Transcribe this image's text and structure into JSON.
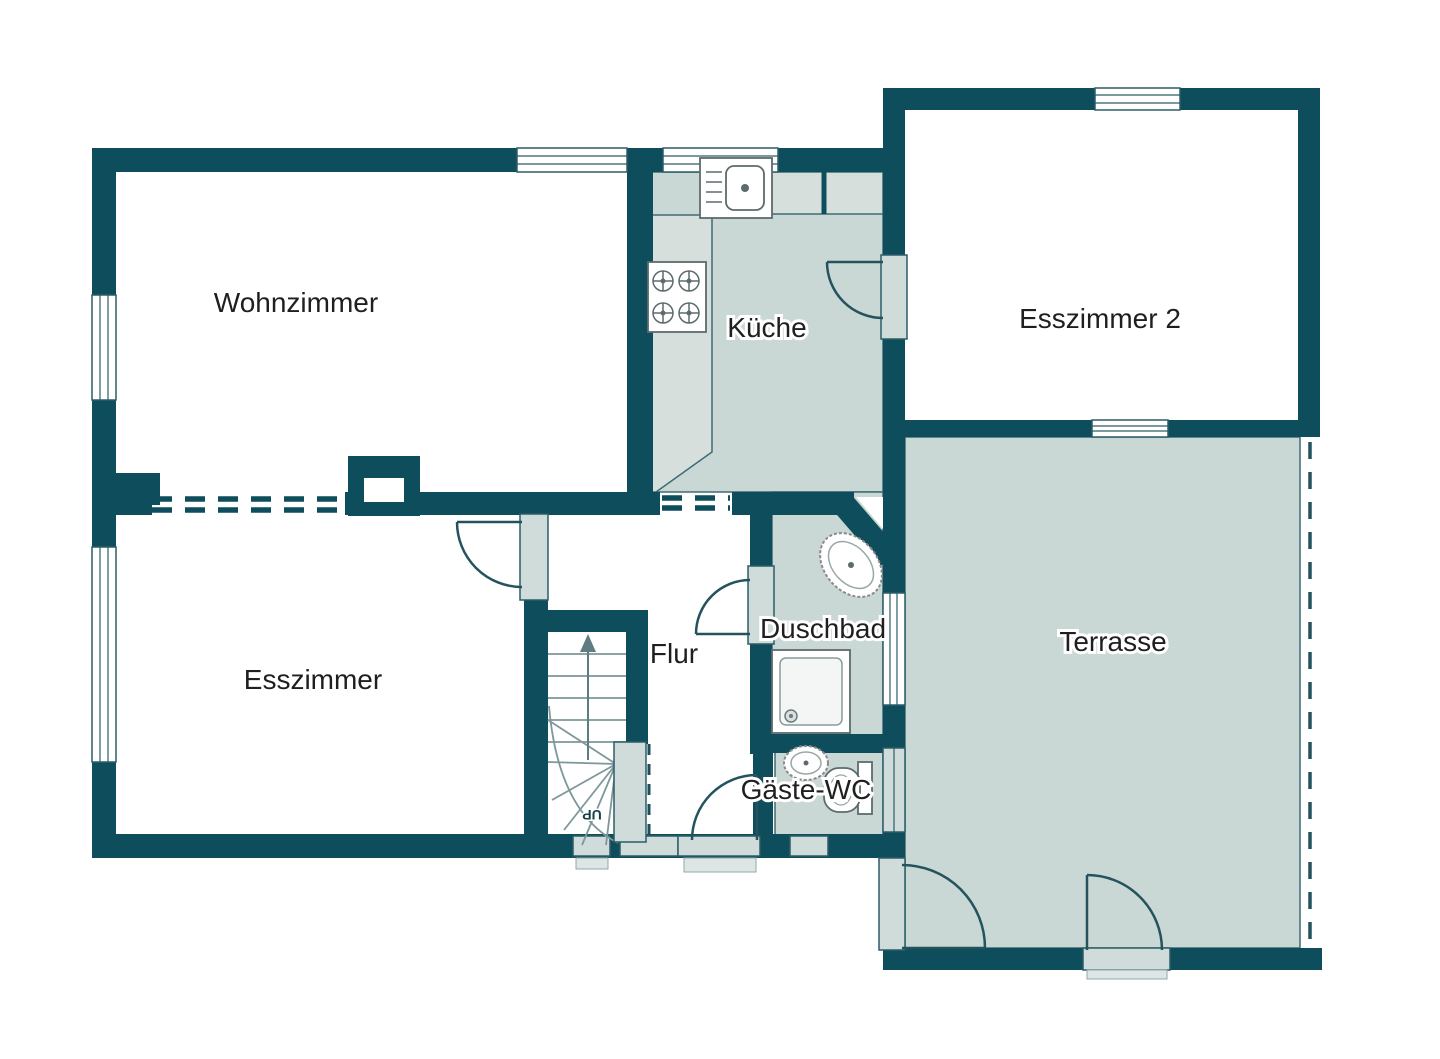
{
  "plan": {
    "type": "floorplan",
    "language": "de",
    "rooms": [
      {
        "id": "wohnzimmer",
        "label": "Wohnzimmer"
      },
      {
        "id": "kueche",
        "label": "Küche"
      },
      {
        "id": "esszimmer-2",
        "label": "Esszimmer 2"
      },
      {
        "id": "terrasse",
        "label": "Terrasse"
      },
      {
        "id": "esszimmer",
        "label": "Esszimmer"
      },
      {
        "id": "flur",
        "label": "Flur"
      },
      {
        "id": "duschbad",
        "label": "Duschbad"
      },
      {
        "id": "gaeste-wc",
        "label": "Gäste-WC"
      }
    ],
    "stairs": {
      "direction_label": "UP"
    },
    "fixtures": [
      "kitchen-sink",
      "stove-cooktop",
      "shower-tray",
      "bathroom-basin",
      "wc-basin",
      "toilet"
    ],
    "colors": {
      "wall": "#0e4d5b",
      "floor_tint": "#c9d7d5",
      "counter_tint": "#d6dfdb",
      "door_frame_tint": "#cfdcd9",
      "background": "#ffffff",
      "label_text": "#1f1f1f"
    }
  }
}
